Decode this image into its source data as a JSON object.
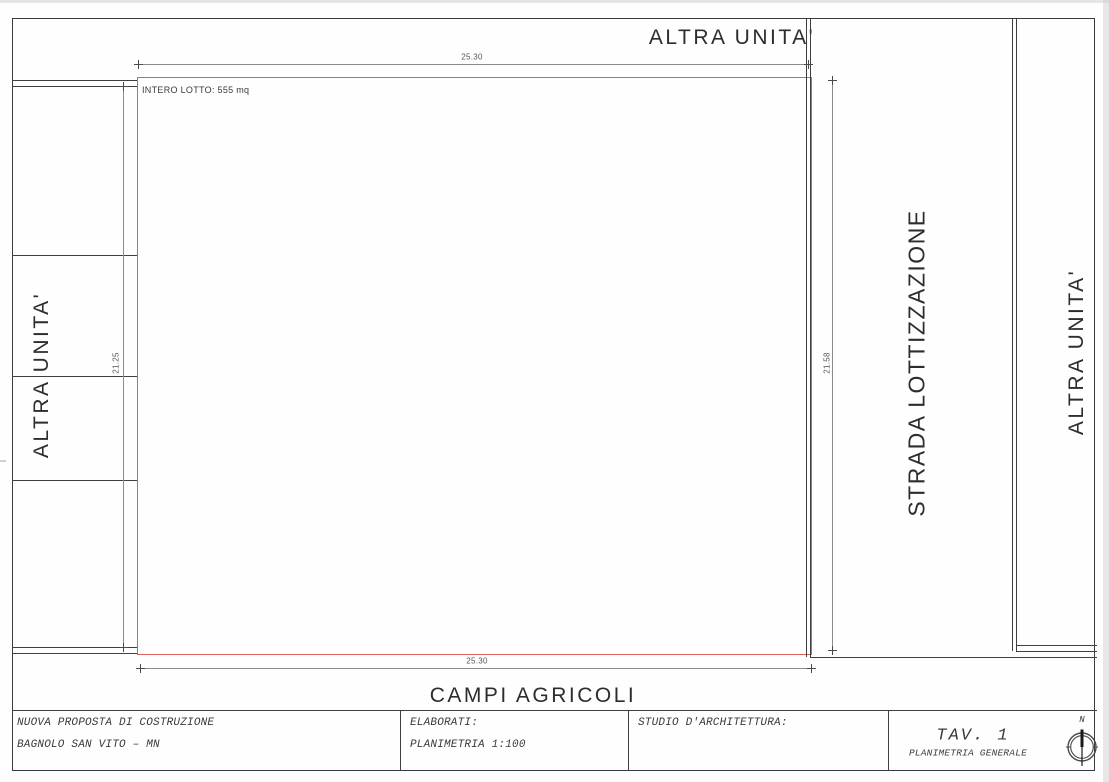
{
  "drawing": {
    "areas": {
      "top_unit": "ALTRA UNITA'",
      "left_unit": "ALTRA UNITA'",
      "right_unit": "ALTRA UNITA'",
      "road": "STRADA LOTTIZZAZIONE",
      "fields": "CAMPI AGRICOLI",
      "lot_label": "INTERO LOTTO: 555 mq"
    },
    "dimensions": {
      "top": "25.30",
      "bottom": "25.30",
      "left": "21.25",
      "right": "21.58"
    }
  },
  "title_block": {
    "project": {
      "line1": "NUOVA PROPOSTA DI COSTRUZIONE",
      "line2": "BAGNOLO SAN VITO – MN"
    },
    "elaborati": {
      "label": "ELABORATI:",
      "value": "PLANIMETRIA 1:100"
    },
    "studio": {
      "label": "STUDIO D'ARCHITETTURA:"
    },
    "sheet": {
      "number": "TAV. 1",
      "title": "PLANIMETRIA GENERALE"
    },
    "compass": {
      "north": "N"
    }
  },
  "colors": {
    "line": "#3f3f3f",
    "dim_line": "#8c8c8c",
    "lot_outline": "#dc6156",
    "text": "#2d2d2d"
  }
}
